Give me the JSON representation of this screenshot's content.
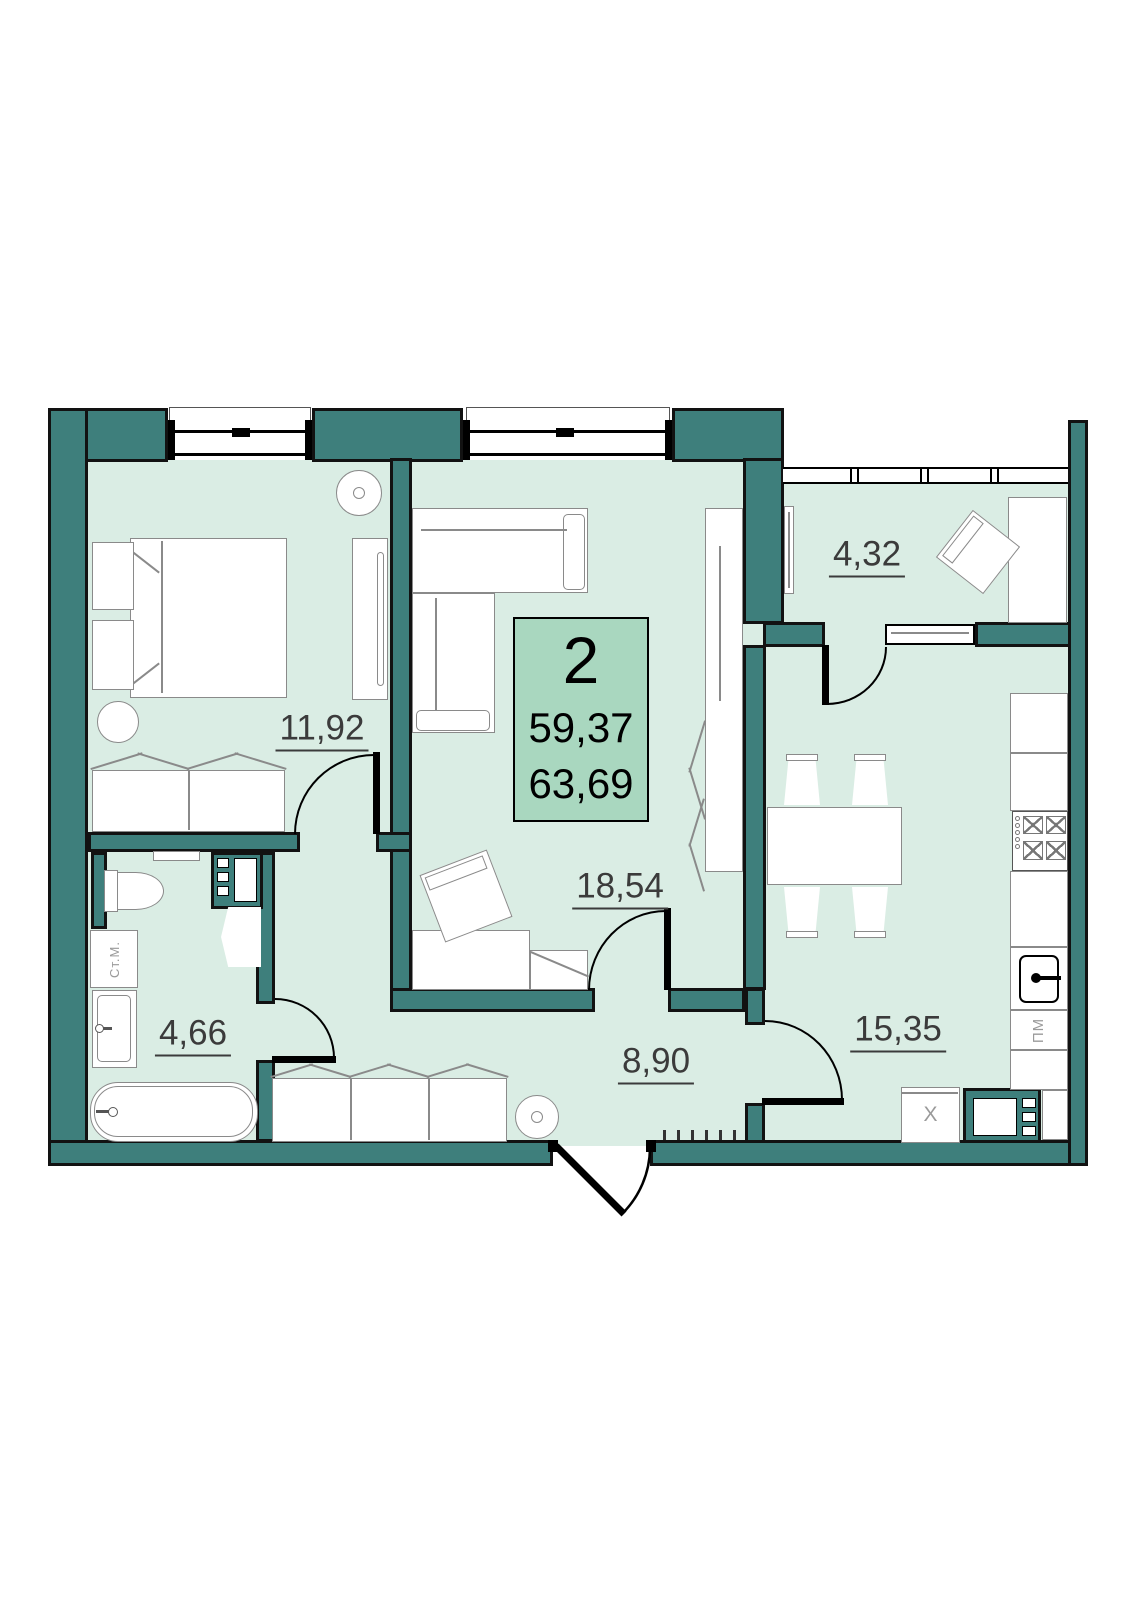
{
  "plan": {
    "rooms_count": "2",
    "living_area": "59,37",
    "total_area": "63,69"
  },
  "rooms": [
    {
      "id": "bedroom",
      "area": "11,92"
    },
    {
      "id": "living-room",
      "area": "18,54"
    },
    {
      "id": "hallway",
      "area": "8,90"
    },
    {
      "id": "bathroom",
      "area": "4,66"
    },
    {
      "id": "kitchen",
      "area": "15,35"
    },
    {
      "id": "balcony",
      "area": "4,32"
    }
  ],
  "appliances": {
    "washing_machine": "Ст.М.",
    "dishwasher": "ПМ",
    "fridge": "X"
  },
  "colors": {
    "wall": "#3E7F7C",
    "floor": "#DAEDE4",
    "info_box": "#A9D7BF"
  }
}
